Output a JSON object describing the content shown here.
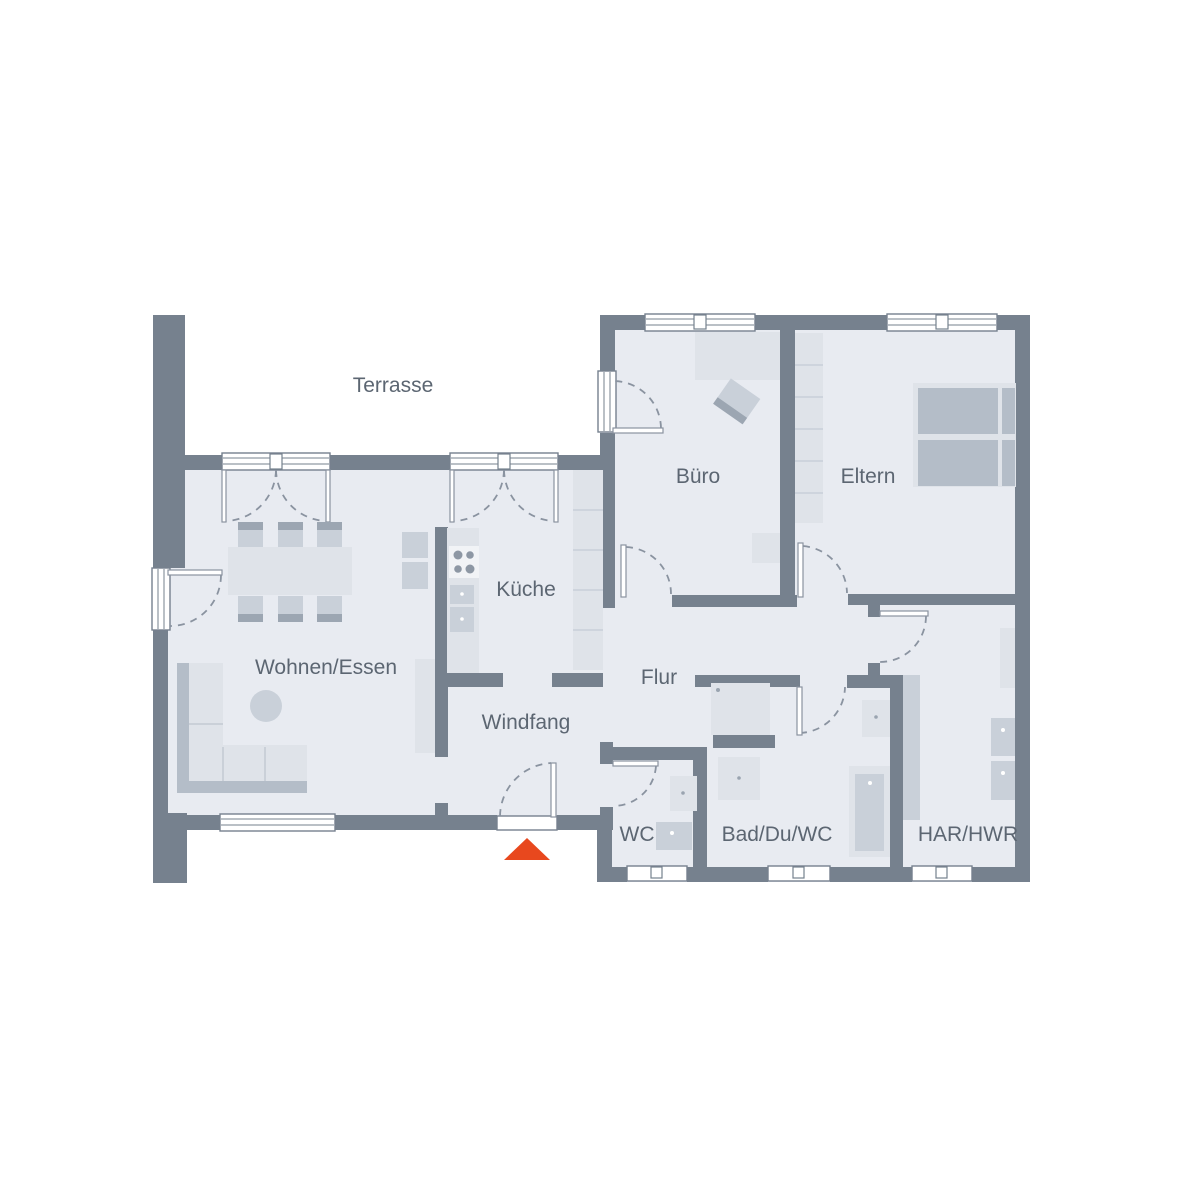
{
  "plan_type": "floor-plan",
  "rooms": [
    {
      "id": "terrasse",
      "label": "Terrasse"
    },
    {
      "id": "wohnen-essen",
      "label": "Wohnen/Essen"
    },
    {
      "id": "kueche",
      "label": "Küche"
    },
    {
      "id": "windfang",
      "label": "Windfang"
    },
    {
      "id": "flur",
      "label": "Flur"
    },
    {
      "id": "buero",
      "label": "Büro"
    },
    {
      "id": "eltern",
      "label": "Eltern"
    },
    {
      "id": "wc",
      "label": "WC"
    },
    {
      "id": "bad-du-wc",
      "label": "Bad/Du/WC"
    },
    {
      "id": "har-hwr",
      "label": "HAR/HWR"
    }
  ],
  "colors": {
    "wall": "#76818E",
    "floor": "#E8EBF1",
    "furniture_light": "#DFE3E9",
    "furniture_mid": "#C9D0D9",
    "furniture_back": "#B4BDC8",
    "furniture_dark": "#9CA6B2",
    "fixture_white": "#F1F3F6",
    "door_line": "#8A93A0",
    "label_text": "#5C6672",
    "entrance_marker": "#E8481E"
  },
  "entrance": {
    "marker_shape": "triangle-up",
    "color": "#E8481E"
  }
}
